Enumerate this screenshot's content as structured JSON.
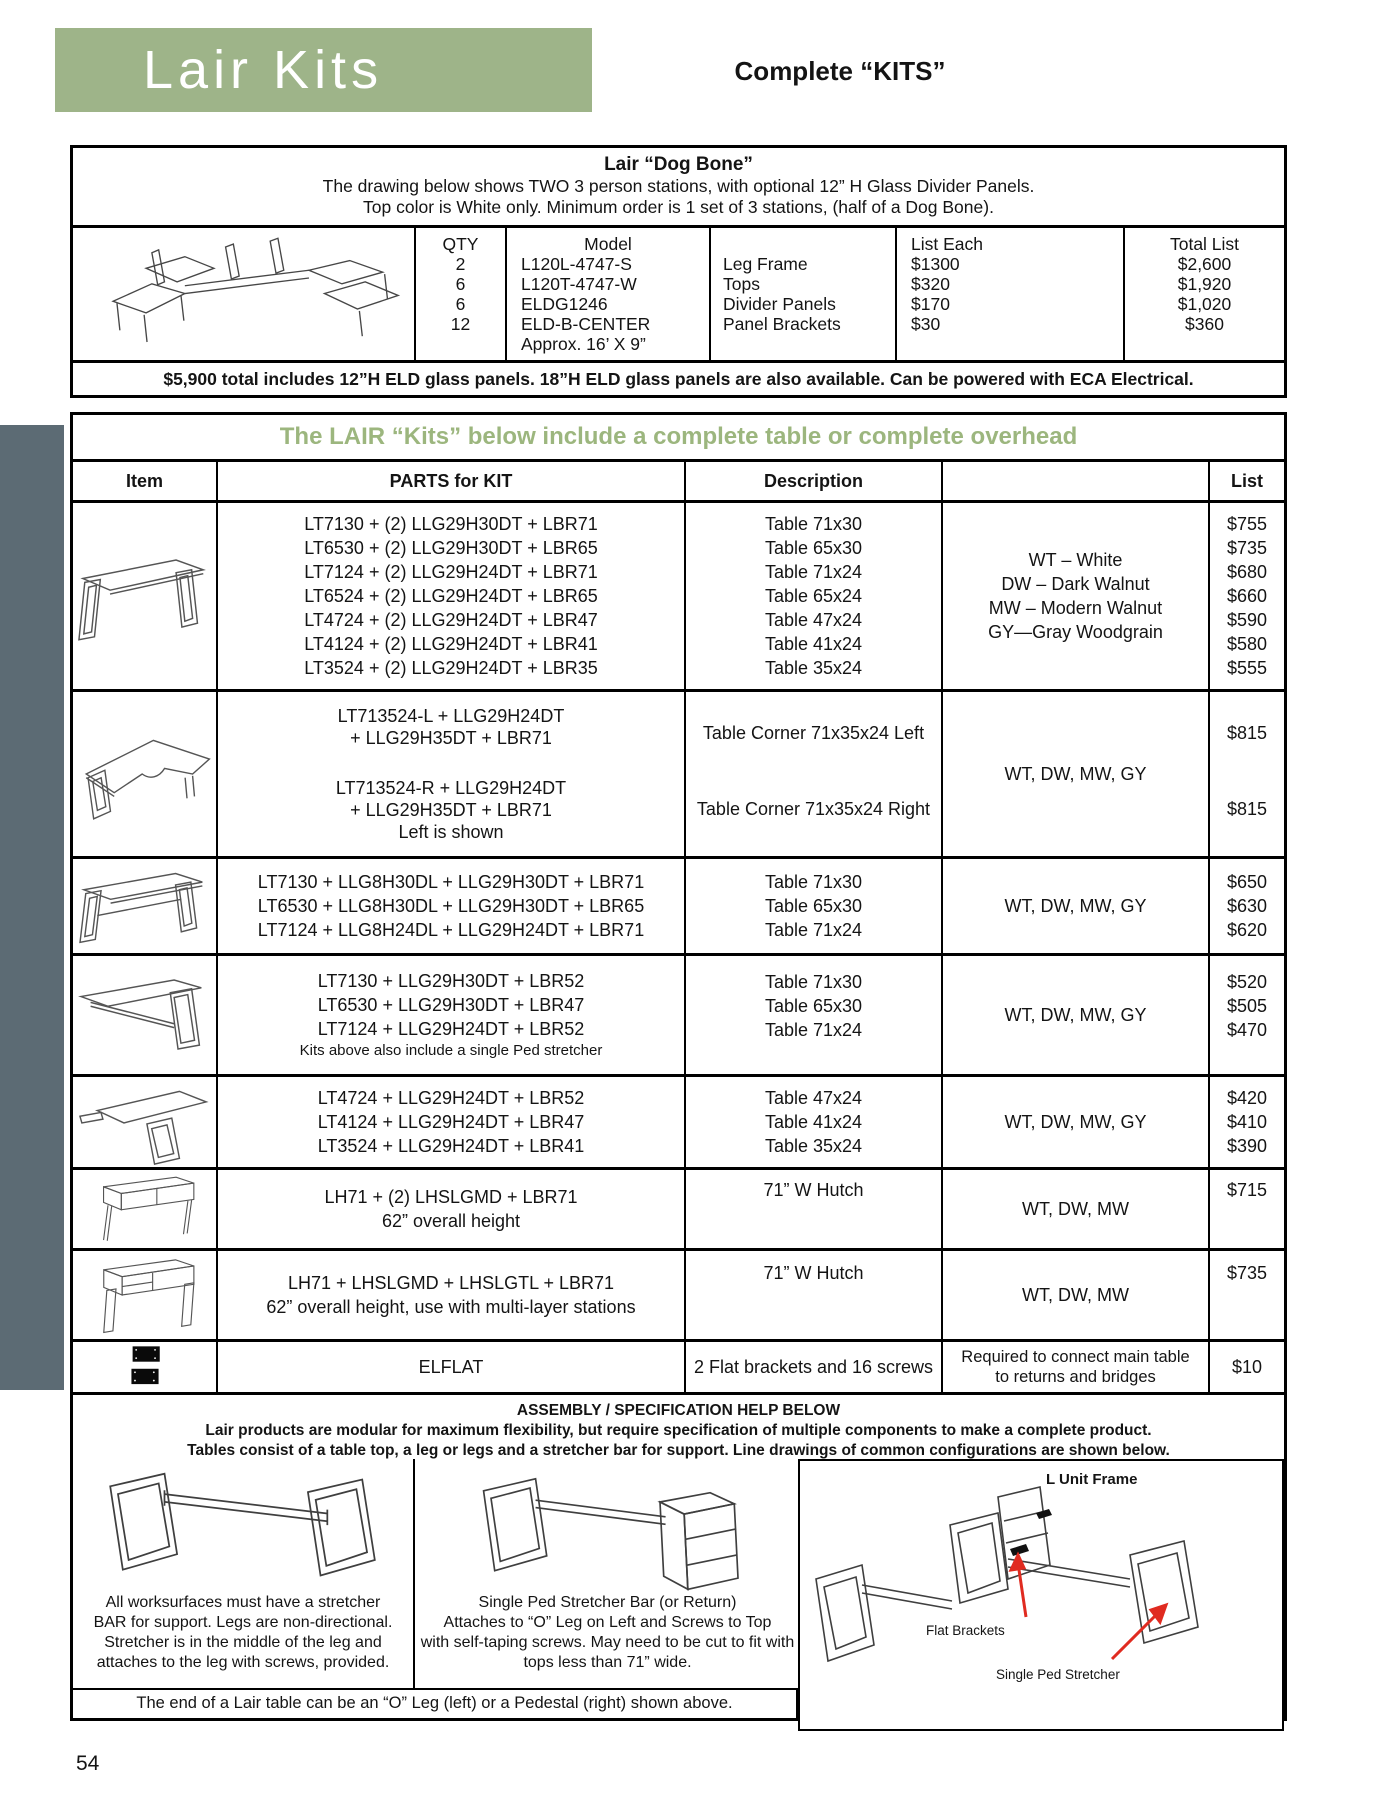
{
  "page_number": "54",
  "header": {
    "title": "Lair Kits",
    "subtitle": "Complete “KITS”"
  },
  "dog_bone": {
    "title": "Lair “Dog Bone”",
    "intro1": "The drawing below shows TWO  3 person stations, with optional 12” H Glass Divider Panels.",
    "intro2": "Top color is White only. Minimum order is 1 set of 3 stations, (half of a Dog Bone).",
    "col_qty": "QTY",
    "col_model": "Model",
    "col_list_each": "List Each",
    "col_total_list": "Total List",
    "qty": [
      "2",
      "6",
      "6",
      "12"
    ],
    "models": [
      "L120L-4747-S",
      "L120T-4747-W",
      "ELDG1246",
      "ELD-B-CENTER"
    ],
    "descs": [
      "Leg Frame",
      "Tops",
      "Divider Panels",
      "Panel Brackets"
    ],
    "list_each": [
      "$1300",
      "$320",
      "$170",
      "$30"
    ],
    "totals": [
      "$2,600",
      "$1,920",
      "$1,020",
      "$360"
    ],
    "approx": "Approx. 16’ X 9”",
    "note": "$5,900 total includes 12”H ELD glass panels.  18”H ELD glass panels are also available. Can be powered with ECA Electrical."
  },
  "kits": {
    "title": "The LAIR “Kits” below include a complete table or complete overhead",
    "col_item": "Item",
    "col_parts": "PARTS for KIT",
    "col_desc": "Description",
    "col_colors": "",
    "col_list": "List",
    "rows": [
      {
        "icon": "two-oleg-table-drawing",
        "parts": [
          "LT7130 + (2) LLG29H30DT + LBR71",
          "LT6530 + (2) LLG29H30DT + LBR65",
          "LT7124 + (2) LLG29H24DT + LBR71",
          "LT6524 + (2) LLG29H24DT + LBR65",
          "LT4724 + (2) LLG29H24DT + LBR47",
          "LT4124 + (2) LLG29H24DT + LBR41",
          "LT3524 + (2) LLG29H24DT + LBR35"
        ],
        "descs": [
          "Table 71x30",
          "Table 65x30",
          "Table 71x24",
          "Table 65x24",
          "Table 47x24",
          "Table 41x24",
          "Table 35x24"
        ],
        "colors": [
          "WT – White",
          "DW – Dark Walnut",
          "MW – Modern Walnut",
          "GY—Gray Woodgrain"
        ],
        "prices": [
          "$755",
          "$735",
          "$680",
          "$660",
          "$590",
          "$580",
          "$555"
        ]
      },
      {
        "icon": "corner-table-drawing",
        "parts_top": [
          "LT713524-L + LLG29H24DT",
          "+ LLG29H35DT + LBR71"
        ],
        "parts_bottom": [
          "LT713524-R + LLG29H24DT",
          "+ LLG29H35DT + LBR71"
        ],
        "parts_note": "Left is shown",
        "descs": [
          "Table Corner 71x35x24 Left",
          "Table Corner 71x35x24 Right"
        ],
        "colors": [
          "WT, DW, MW, GY"
        ],
        "prices": [
          "$815",
          "$815"
        ]
      },
      {
        "icon": "table-with-stretcher-drawing",
        "parts": [
          "LT7130 + LLG8H30DL + LLG29H30DT + LBR71",
          "LT6530 + LLG8H30DL + LLG29H30DT + LBR65",
          "LT7124 + LLG8H24DL + LLG29H24DT + LBR71"
        ],
        "descs": [
          "Table 71x30",
          "Table 65x30",
          "Table 71x24"
        ],
        "colors": [
          "WT, DW, MW, GY"
        ],
        "prices": [
          "$650",
          "$630",
          "$620"
        ]
      },
      {
        "icon": "single-oleg-table-drawing",
        "parts": [
          "LT7130 + LLG29H30DT + LBR52",
          "LT6530 + LLG29H30DT + LBR47",
          "LT7124 + LLG29H24DT + LBR52"
        ],
        "parts_note": "Kits above also include a single Ped stretcher",
        "descs": [
          "Table 71x30",
          "Table 65x30",
          "Table 71x24"
        ],
        "colors": [
          "WT, DW, MW, GY"
        ],
        "prices": [
          "$520",
          "$505",
          "$470"
        ]
      },
      {
        "icon": "angled-return-table-drawing",
        "parts": [
          "LT4724 + LLG29H24DT + LBR52",
          "LT4124 + LLG29H24DT + LBR47",
          "LT3524 + LLG29H24DT + LBR41"
        ],
        "descs": [
          "Table 47x24",
          "Table 41x24",
          "Table 35x24"
        ],
        "colors": [
          "WT, DW, MW, GY"
        ],
        "prices": [
          "$420",
          "$410",
          "$390"
        ]
      },
      {
        "icon": "hutch-drawing",
        "parts": [
          "LH71 + (2) LHSLGMD + LBR71",
          "62” overall height"
        ],
        "descs": [
          "71” W Hutch"
        ],
        "colors": [
          "WT, DW, MW"
        ],
        "prices": [
          "$715"
        ]
      },
      {
        "icon": "multi-layer-hutch-drawing",
        "parts": [
          "LH71 + LHSLGMD + LHSLGTL + LBR71",
          "62” overall height, use with multi-layer stations"
        ],
        "descs": [
          "71” W Hutch"
        ],
        "colors": [
          "WT, DW, MW"
        ],
        "prices": [
          "$735"
        ]
      },
      {
        "icon": "flat-brackets-image",
        "parts": [
          "ELFLAT"
        ],
        "descs": [
          "2 Flat brackets and 16 screws"
        ],
        "colors": [
          "Required to connect main table",
          "to returns and bridges"
        ],
        "prices": [
          "$10"
        ]
      }
    ]
  },
  "assembly": {
    "title": "ASSEMBLY / SPECIFICATION HELP BELOW",
    "line1": "Lair products are modular for maximum flexibility, but require specification of multiple components to make a complete product.",
    "line2": "Tables consist of a table top, a leg or legs and a stretcher bar for support.  Line drawings of common configurations are shown below."
  },
  "bottom": {
    "left_note": "All worksurfaces must have a stretcher BAR for support. Legs are non-directional. Stretcher is in the middle of the leg and attaches to the leg with screws, provided.",
    "middle_note": [
      "Single Ped Stretcher Bar (or Return)",
      "Attaches to “O” Leg on Left and Screws to Top",
      "with self-taping screws. May need to be cut to fit with",
      "tops less than 71” wide."
    ],
    "l_unit_frame_label": "L Unit Frame",
    "flat_brackets_label": "Flat Brackets",
    "single_ped_label": "Single Ped Stretcher",
    "footer": "The end of a Lair table can be an “O” Leg (left) or a Pedestal (right) shown above."
  },
  "colors": {
    "banner_green": "#9eb489",
    "title_green": "#9cb67e",
    "sidebar_slate": "#5c6b74",
    "arrow_red": "#e02b20"
  }
}
